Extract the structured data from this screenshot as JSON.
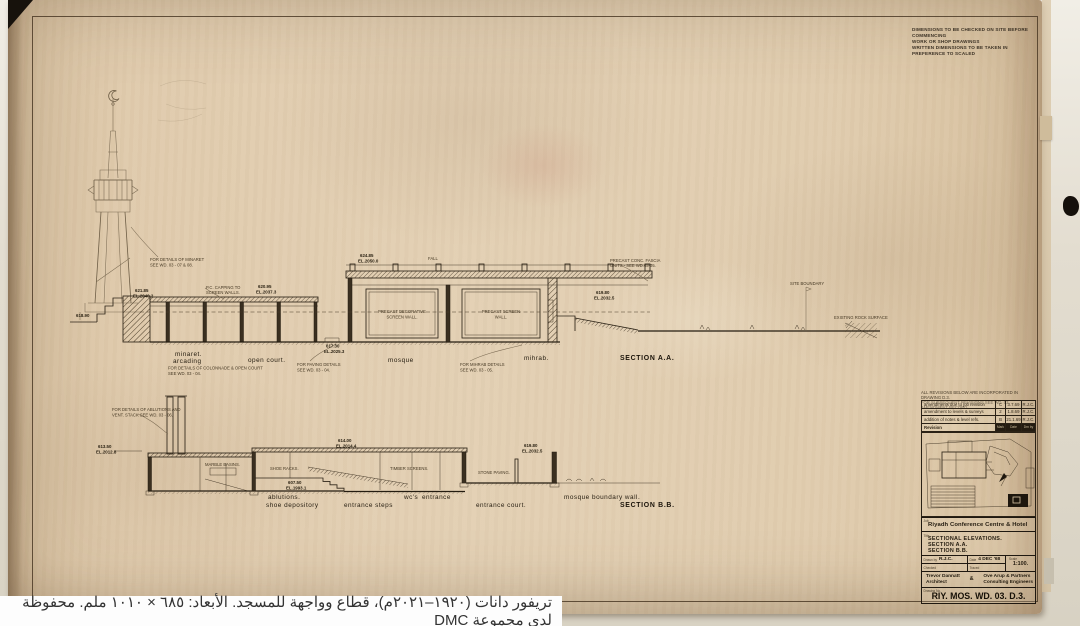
{
  "caption": {
    "text": "تريفور دانات (١٩٢٠–٢٠٢١م)، قطاع وواجهة للمسجد. الأبعاد: ٦٨٥ × ١٠١٠ ملم. محفوظة لدى مجموعة DMC"
  },
  "notes_top_right": {
    "lines": [
      "DIMENSIONS TO BE CHECKED ON SITE BEFORE COMMENCING",
      "WORK OR SHOP DRAWINGS",
      "WRITTEN DIMENSIONS TO BE TAKEN IN PREFERENCE TO SCALED"
    ]
  },
  "revision_table": {
    "notes": [
      "ALL REVISIONS BELOW ARE INCORPORATED IN DRAWING D.3.",
      "FOR SUBSEQUENT REVISIONS SEE WD. 03 AMENDMENT RECORD."
    ],
    "rows": [
      {
        "desc": "amendments due to job revision",
        "mark": "C",
        "date": "3.7.69",
        "by": "R.J.C."
      },
      {
        "desc": "amendment to levels & surveys",
        "mark": "2",
        "date": "1.8.69",
        "by": "R.J.C."
      },
      {
        "desc": "addition of notes & level refs.",
        "mark": "B",
        "date": "21.1.69",
        "by": "R.J.C."
      }
    ],
    "footer": {
      "revision_label": "Revision",
      "mark_label": "Mark",
      "date_label": "Date",
      "by_label": "Drn by"
    }
  },
  "title_block": {
    "job_label": "Job",
    "project": "Riyadh Conference Centre & Hotel",
    "title_label": "Title",
    "title_lines": [
      "SECTIONAL ELEVATIONS.",
      "SECTION A.A.",
      "SECTION B.B."
    ],
    "drawn_by_label": "Drawn by",
    "drawn_by": "R.J.C.",
    "checked_label": "Checked",
    "date_label": "Date",
    "date": "4 DEC '68",
    "traced_label": "Traced",
    "scale_label": "Scale",
    "scale": "1:100.",
    "architect": [
      "Trevor Dannatt",
      "Architect"
    ],
    "ampersand": "&",
    "engineer": [
      "Ove Arup & Partners",
      "Consulting Engineers"
    ],
    "drawing_no_label": "Drawing No.",
    "drawing_no": "RIY. MOS. WD. 03.  D.3."
  },
  "drawing": {
    "sectionA": {
      "labels": [
        {
          "x": 175,
          "y": 356,
          "t": "minaret.",
          "c": "lbl"
        },
        {
          "x": 173,
          "y": 363,
          "t": "arcading",
          "c": "lbl"
        },
        {
          "x": 248,
          "y": 362,
          "t": "open court.",
          "c": "lbl"
        },
        {
          "x": 388,
          "y": 362,
          "t": "mosque",
          "c": "lbl"
        },
        {
          "x": 524,
          "y": 360,
          "t": "mihrab.",
          "c": "lbl"
        },
        {
          "x": 620,
          "y": 360,
          "t": "SECTION A.A.",
          "c": "sec"
        }
      ],
      "annotations": [
        {
          "x": 135,
          "y": 292,
          "t": "621.85",
          "c": "lvl"
        },
        {
          "x": 133,
          "y": 297.5,
          "t": "EL.2040.2",
          "c": "lvl"
        },
        {
          "x": 206,
          "y": 289,
          "t": "P.C. CAPPING TO"
        },
        {
          "x": 206,
          "y": 294,
          "t": "SCREEN WALLS."
        },
        {
          "x": 258,
          "y": 288,
          "t": "620.95",
          "c": "lvl"
        },
        {
          "x": 256,
          "y": 293.5,
          "t": "EL.2037.3",
          "c": "lvl"
        },
        {
          "x": 360,
          "y": 257,
          "t": "624.85",
          "c": "lvl"
        },
        {
          "x": 358,
          "y": 262.5,
          "t": "EL.2050.0",
          "c": "lvl"
        },
        {
          "x": 428,
          "y": 260,
          "t": "FALL"
        },
        {
          "x": 610,
          "y": 262,
          "t": "PRECAST CONC. FASCIA"
        },
        {
          "x": 610,
          "y": 267,
          "t": "UNITS - SEE WD.03-05."
        },
        {
          "x": 326,
          "y": 347.5,
          "t": "617.30",
          "c": "lvl"
        },
        {
          "x": 324,
          "y": 353,
          "t": "EL.2025.3",
          "c": "lvl"
        },
        {
          "x": 596,
          "y": 294,
          "t": "619.80",
          "c": "lvl"
        },
        {
          "x": 594,
          "y": 299.5,
          "t": "EL.2032.5",
          "c": "lvl"
        },
        {
          "x": 76,
          "y": 317,
          "t": "618.90",
          "c": "lvl"
        },
        {
          "x": 150,
          "y": 261,
          "t": "FOR DETAILS OF MINARET"
        },
        {
          "x": 150,
          "y": 266.5,
          "t": "SEE WD. 03 - 07 & 08."
        },
        {
          "x": 297,
          "y": 366,
          "t": "FOR PAVING DETAILS"
        },
        {
          "x": 297,
          "y": 371.5,
          "t": "SEE WD. 03 - 04."
        },
        {
          "x": 460,
          "y": 366,
          "t": "FOR MIHRAB DETAILS"
        },
        {
          "x": 460,
          "y": 371.5,
          "t": "SEE WD. 03 - 05."
        },
        {
          "x": 168,
          "y": 369.5,
          "t": "FOR DETAILS OF COLONNADE & OPEN COURT"
        },
        {
          "x": 168,
          "y": 375,
          "t": "SEE WD. 03 - 04."
        },
        {
          "x": 402,
          "y": 313,
          "t": "PRECAST DECORATIVE",
          "a": "middle"
        },
        {
          "x": 402,
          "y": 318.5,
          "t": "SCREEN WALL.",
          "a": "middle"
        },
        {
          "x": 501,
          "y": 313,
          "t": "PRECAST SCREEN",
          "a": "middle"
        },
        {
          "x": 501,
          "y": 318.5,
          "t": "WALL.",
          "a": "middle"
        },
        {
          "x": 790,
          "y": 285,
          "t": "SITE BOUNDARY"
        },
        {
          "x": 834,
          "y": 319,
          "t": "EXISTING ROCK SURFACE"
        }
      ]
    },
    "sectionB": {
      "labels": [
        {
          "x": 268,
          "y": 499,
          "t": "ablutions.",
          "c": "lbl"
        },
        {
          "x": 266,
          "y": 507,
          "t": "shoe depository",
          "c": "lbl"
        },
        {
          "x": 344,
          "y": 507,
          "t": "entrance steps",
          "c": "lbl"
        },
        {
          "x": 404,
          "y": 499,
          "t": "wc's",
          "c": "lbl"
        },
        {
          "x": 422,
          "y": 499,
          "t": "entrance",
          "c": "lbl"
        },
        {
          "x": 476,
          "y": 507,
          "t": "entrance court.",
          "c": "lbl"
        },
        {
          "x": 564,
          "y": 499,
          "t": "mosque boundary wall.",
          "c": "lbl"
        },
        {
          "x": 620,
          "y": 507,
          "t": "SECTION B.B.",
          "c": "sec"
        }
      ],
      "annotations": [
        {
          "x": 112,
          "y": 411,
          "t": "FOR DETAILS OF ABLUTIONS AND"
        },
        {
          "x": 112,
          "y": 416.5,
          "t": "VENT. STACK SEE WD. 03 - 06."
        },
        {
          "x": 98,
          "y": 448,
          "t": "613.50",
          "c": "lvl"
        },
        {
          "x": 96,
          "y": 453.5,
          "t": "EL.2012.8",
          "c": "lvl"
        },
        {
          "x": 338,
          "y": 442,
          "t": "614.00",
          "c": "lvl"
        },
        {
          "x": 336,
          "y": 447.5,
          "t": "EL.2014.4",
          "c": "lvl"
        },
        {
          "x": 524,
          "y": 447,
          "t": "619.80",
          "c": "lvl"
        },
        {
          "x": 522,
          "y": 452.5,
          "t": "EL.2032.5",
          "c": "lvl"
        },
        {
          "x": 288,
          "y": 484,
          "t": "607.50",
          "c": "lvl"
        },
        {
          "x": 286,
          "y": 489.5,
          "t": "EL.1993.1",
          "c": "lvl"
        },
        {
          "x": 205,
          "y": 466,
          "t": "MARBLE BASINS."
        },
        {
          "x": 270,
          "y": 470,
          "t": "SHOE RACKS."
        },
        {
          "x": 390,
          "y": 470,
          "t": "TIMBER SCREENS."
        },
        {
          "x": 478,
          "y": 474,
          "t": "STONE PAVING."
        }
      ]
    }
  }
}
